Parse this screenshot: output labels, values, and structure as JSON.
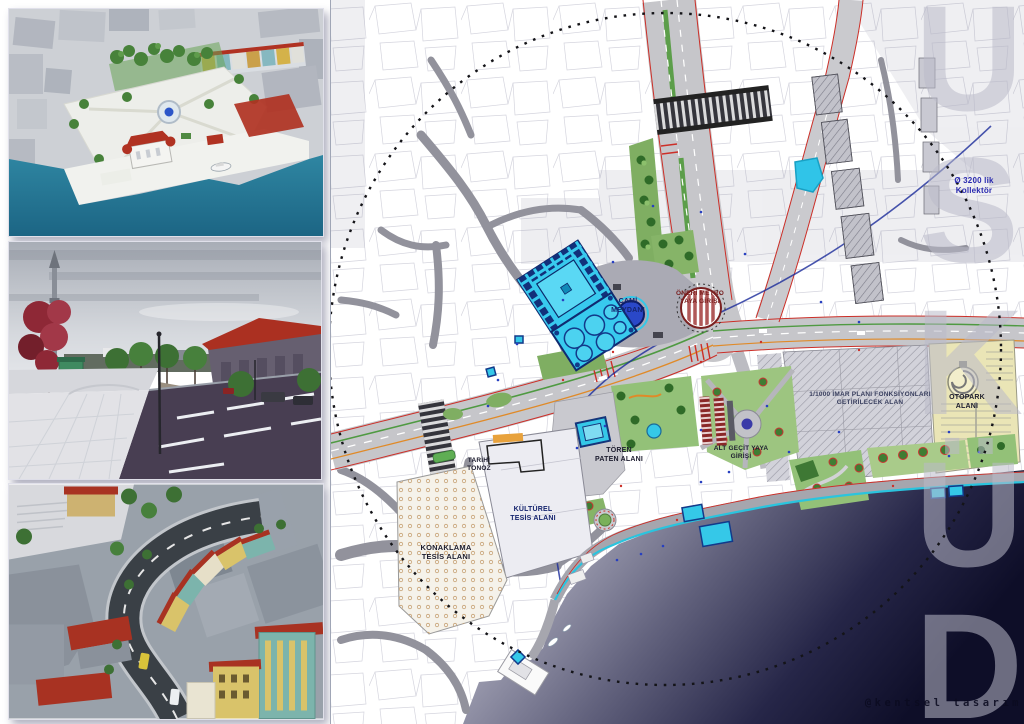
{
  "board": {
    "type": "urban-design-presentation-board",
    "watermark": {
      "text": "@kentsel tasarım"
    }
  },
  "renders": [
    {
      "id": "aerial-waterfront-square-render"
    },
    {
      "id": "street-level-boulevard-render"
    },
    {
      "id": "aerial-street-facades-render"
    }
  ],
  "map": {
    "big_letters": [
      "Ü",
      "S",
      "K",
      "Ü",
      "D"
    ],
    "labels": {
      "kollektor": {
        "text": "Ø 3200 lik Kollektör"
      },
      "cami_meydani": {
        "text": "CAMİ MEYDANI"
      },
      "metro_giris": {
        "text": "ÖNERİ METRO YAYA GİRİŞİ"
      },
      "tarihi_tonoz": {
        "text": "TARİHİ TONOZ"
      },
      "kulturel": {
        "text": "KÜLTÜREL TESİS ALANI"
      },
      "konaklama": {
        "text": "KONAKLAMA TESİS ALANI"
      },
      "toren": {
        "text": "TÖREN PATEN ALANI"
      },
      "alt_gecit": {
        "text": "ALT GEÇİT YAYA GİRİŞİ"
      },
      "imar": {
        "text": "1/1000 İMAR PLANI FONKSİYONLARI GETİRİLECEK ALAN"
      },
      "otopark": {
        "text": "OTOPARK ALANI"
      }
    },
    "colors": {
      "sea_deep": "#0e0e28",
      "sea_near_shore": "#a6a6b8",
      "pool_cyan": "#35c8e8",
      "park_green": "#93c178",
      "roof_red": "#ab3021",
      "road_gray": "#c6c6ca",
      "label_blue": "#15246e",
      "label_dark_red": "#7a2020"
    }
  }
}
